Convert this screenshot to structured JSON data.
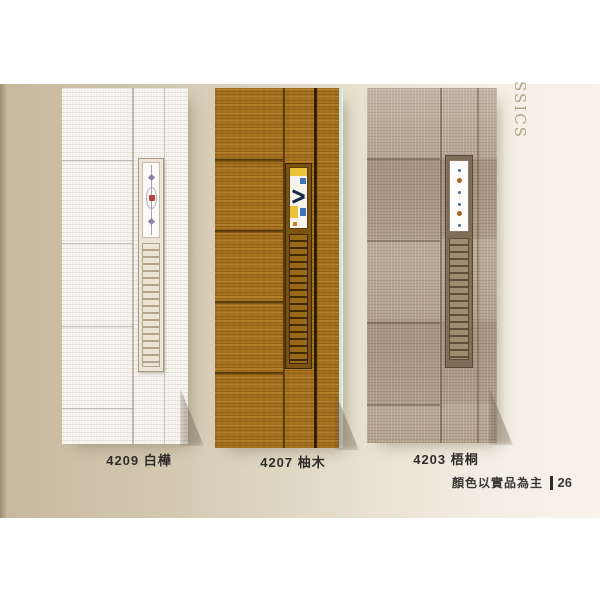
{
  "page": {
    "collection_text": "SSICS",
    "footer_note": "顏色以實品為主",
    "page_number": "26"
  },
  "products": [
    {
      "code": "4209",
      "name": "白樺"
    },
    {
      "code": "4207",
      "name": "柚木"
    },
    {
      "code": "4203",
      "name": "梧桐"
    }
  ],
  "colors": {
    "background_left": "#c6b89d",
    "background_right": "#f7f3eb",
    "door_birch": "#f3f1eb",
    "door_teak": "#a8731f",
    "door_paulownia": "#b1a08c",
    "label_text": "#2f2d29",
    "side_text": "#b2a489",
    "glass_gem_red": "#b5423e",
    "stained_glass_yellow": "#e9c33a",
    "stained_glass_blue": "#3f74b8",
    "dot_blue": "#4a6da8",
    "dot_amber": "#aa6426"
  }
}
